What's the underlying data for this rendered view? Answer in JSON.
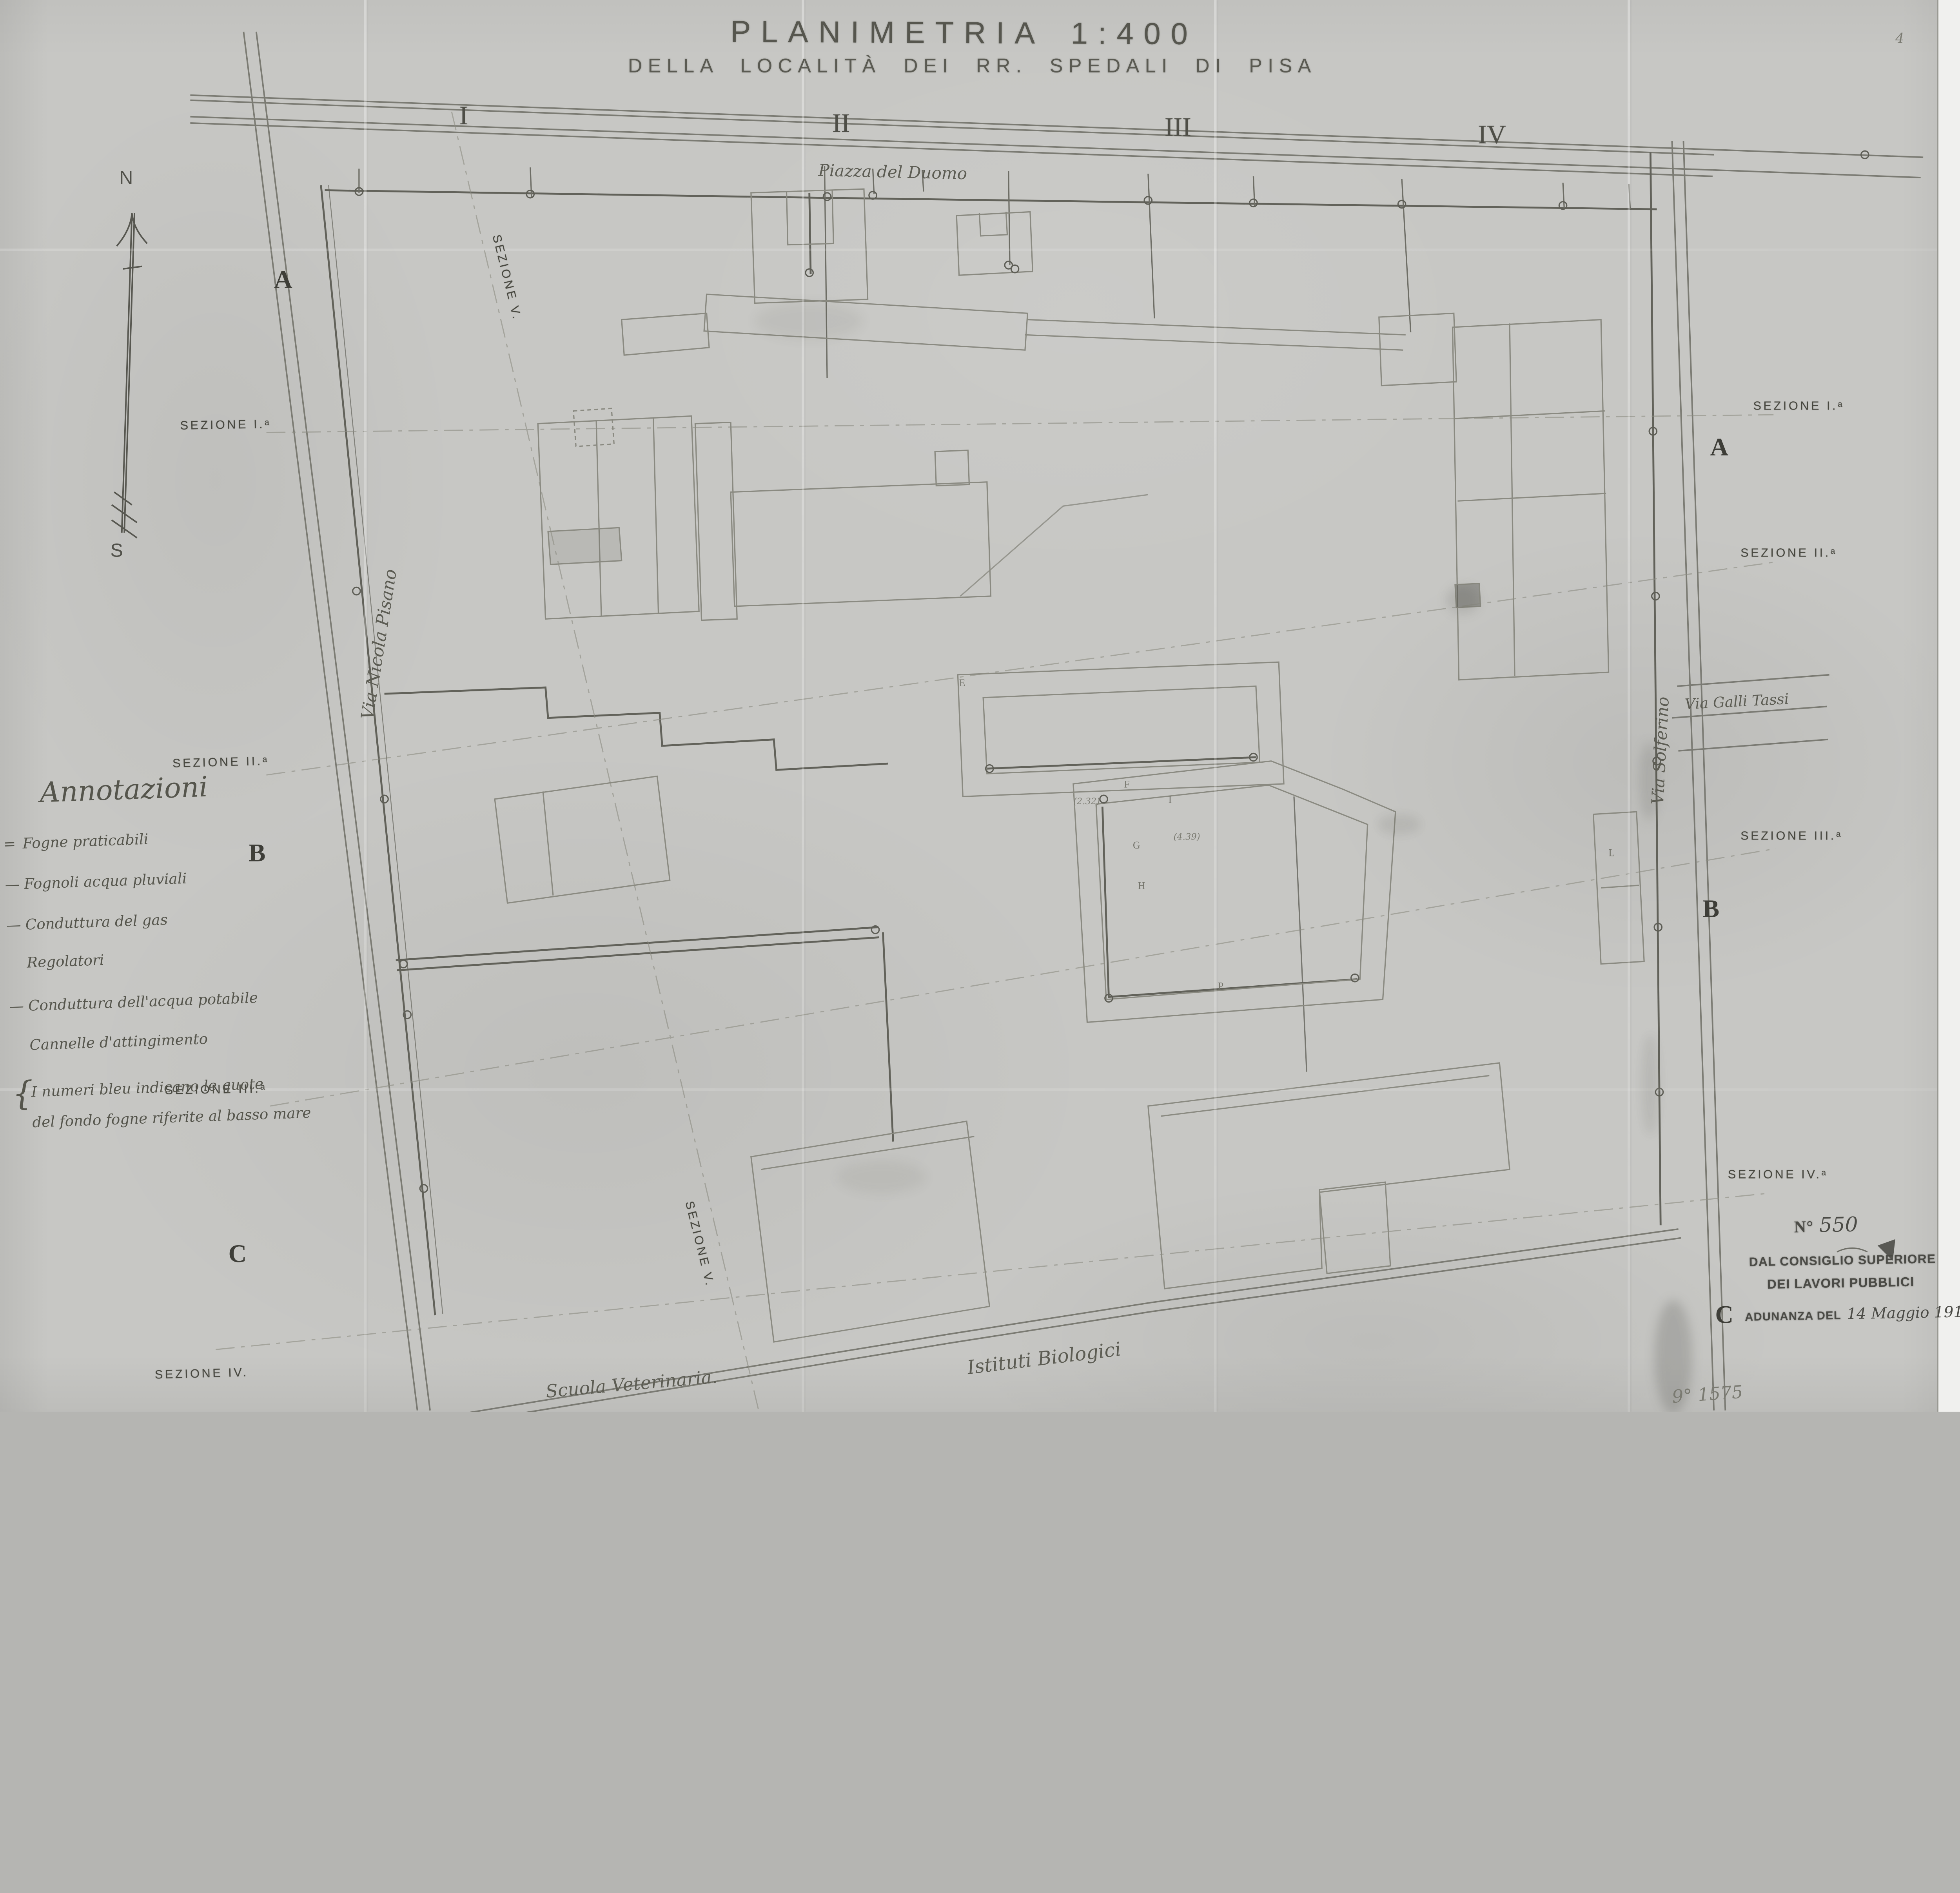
{
  "title": {
    "line1": "PLANIMETRIA 1:400",
    "line2": "DELLA LOCALITÀ DEI RR. SPEDALI DI PISA"
  },
  "grid_numerals": {
    "i": "I",
    "ii": "II",
    "iii": "III",
    "iv": "IV"
  },
  "compass": {
    "north": "N",
    "south": "S"
  },
  "labels": {
    "piazza": "Piazza del Duomo",
    "street_left": "Via Nicola Pisano",
    "street_right": "Via Solferino",
    "street_cross": "Via Galli Tassi",
    "school": "Scuola Veterinaria.",
    "institutes": "Istituti Biologici"
  },
  "sections": {
    "left_i": "SEZIONE I.ᵃ",
    "left_ii": "SEZIONE II.ᵃ",
    "left_iii": "SEZIONE III.ᵃ",
    "left_iv": "SEZIONE IV.",
    "right_i": "SEZIONE I.ᵃ",
    "right_ii": "SEZIONE II.ᵃ",
    "right_iii": "SEZIONE III.ᵃ",
    "right_iv": "SEZIONE IV.ᵃ",
    "diag_top": "SEZIONE V.",
    "diag_bottom": "SEZIONE V."
  },
  "row_letters": {
    "left_a": "A",
    "left_b": "B",
    "left_c": "C",
    "right_a": "A",
    "right_b": "B",
    "right_c": "C"
  },
  "legend": {
    "heading": "Annotazioni",
    "items": [
      {
        "marker": "=",
        "label": "Fogne praticabili"
      },
      {
        "marker": "—",
        "label": "Fognoli acqua pluviali"
      },
      {
        "marker": "—",
        "label": "Conduttura del gas"
      },
      {
        "marker": "",
        "label": "Regolatori"
      },
      {
        "marker": "—",
        "label": "Conduttura dell'acqua potabile"
      },
      {
        "marker": "",
        "label": "Cannelle d'attingimento"
      },
      {
        "marker": "{",
        "label": "I numeri bleu indicano le quote"
      },
      {
        "marker": "",
        "label": "del fondo fogne riferite al basso mare"
      }
    ]
  },
  "stamp": {
    "number_label": "N°",
    "number": "550",
    "line1": "DAL CONSIGLIO SUPERIORE",
    "line2": "DEI LAVORI PUBBLICI",
    "line3_printed": "ADUNANZA DEL",
    "line3_hand": "14 Maggio 1915"
  },
  "marks": {
    "top_right": "4",
    "bottom_right": "9° 1575"
  },
  "points": {
    "f": "F",
    "g": "G",
    "h": "H",
    "i": "I",
    "e": "E",
    "p": "P",
    "l": "L",
    "q1": "(2.32)",
    "q2": "(4.39)"
  }
}
